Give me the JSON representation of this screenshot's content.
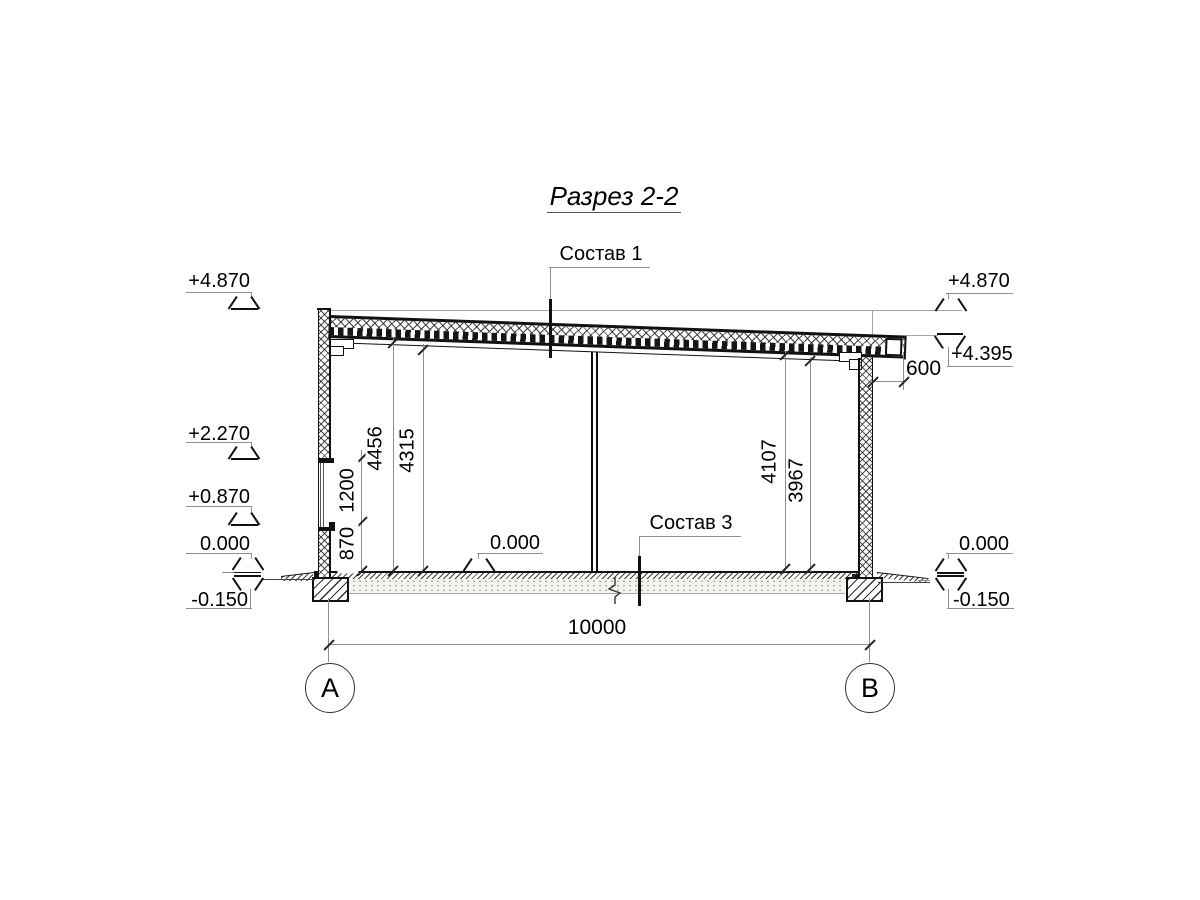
{
  "sheet": {
    "title": "Разрез 2-2"
  },
  "callouts": {
    "roof_composition": "Состав 1",
    "floor_composition": "Состав 3"
  },
  "elevations": {
    "left": {
      "parapet_top": "+4.870",
      "opening_head": "+2.270",
      "opening_sill": "+0.870",
      "floor": "0.000",
      "ground": "-0.150"
    },
    "middle": {
      "floor": "0.000"
    },
    "right": {
      "roof_high": "+4.870",
      "roof_low": "+4.395",
      "floor": "0.000",
      "ground": "-0.150"
    }
  },
  "dimensions": {
    "span": "10000",
    "roof_overhang": "600",
    "left_height_to_deck": "4456",
    "left_clear_height": "4315",
    "opening_height": "1200",
    "sill_height": "870",
    "right_height_to_deck": "4107",
    "right_clear_height": "3967"
  },
  "axes": {
    "a": "A",
    "b": "B"
  },
  "colors": {
    "line_dark": "#111111",
    "line_thin": "#8f8f8f",
    "paper": "#ffffff"
  }
}
